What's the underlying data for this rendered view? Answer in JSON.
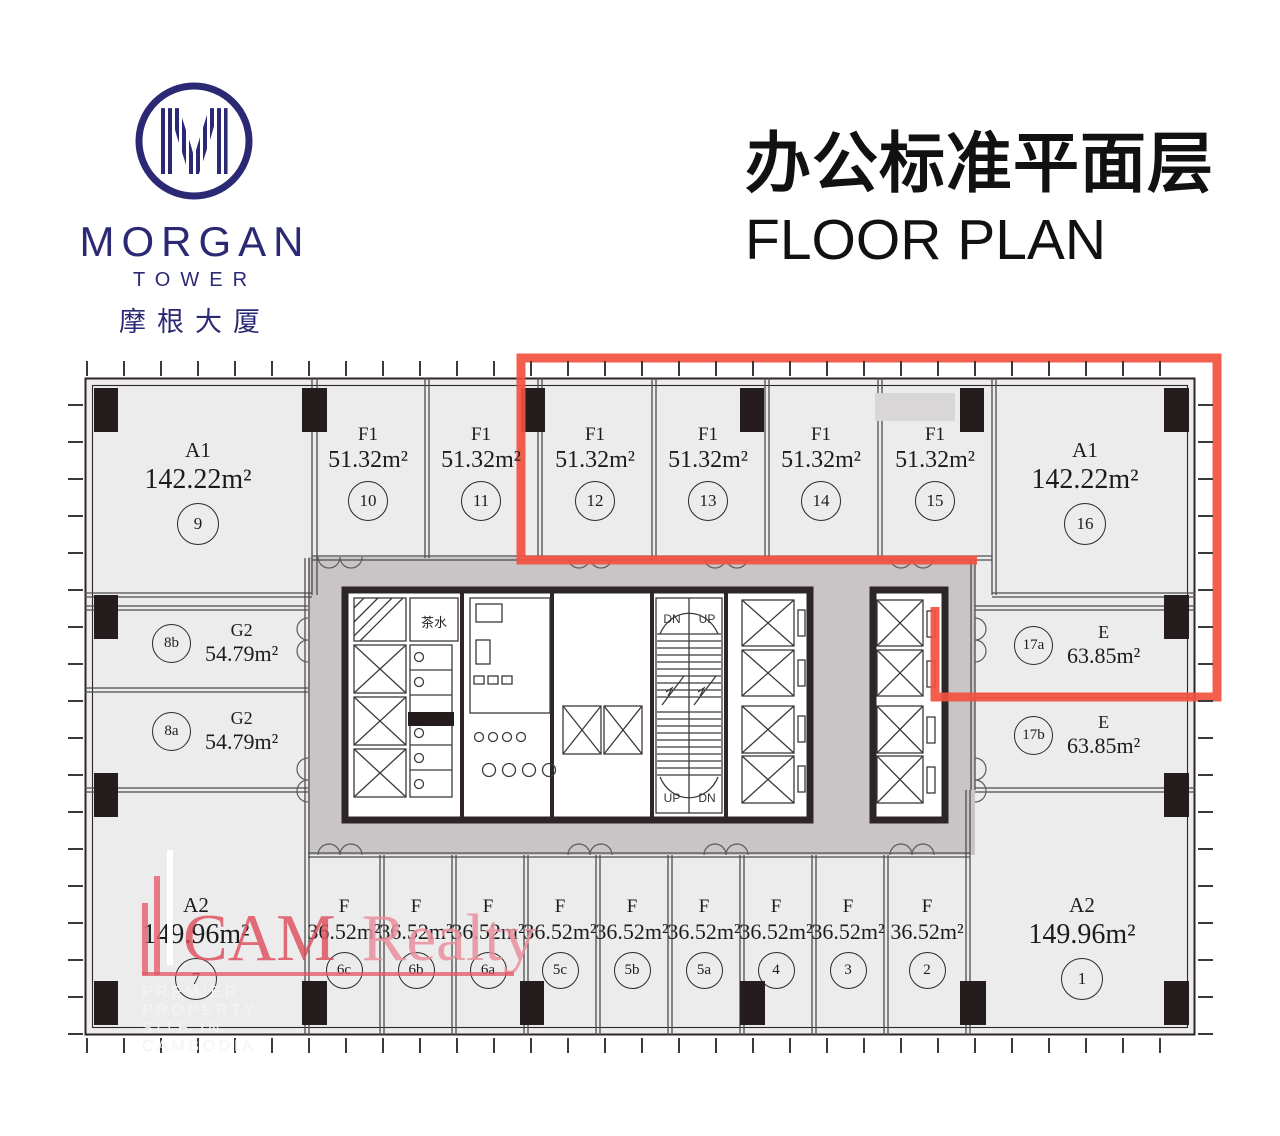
{
  "brand": {
    "monogram": "M",
    "name": "MORGAN",
    "subtitle": "TOWER",
    "chinese": "摩根大厦",
    "color": "#2b2973"
  },
  "title": {
    "zh": "办公标准平面层",
    "en": "FLOOR PLAN"
  },
  "plan": {
    "top_units": [
      {
        "type": "A1",
        "area": "142.22m²",
        "no": "9"
      },
      {
        "type": "F1",
        "area": "51.32m²",
        "no": "10"
      },
      {
        "type": "F1",
        "area": "51.32m²",
        "no": "11"
      },
      {
        "type": "F1",
        "area": "51.32m²",
        "no": "12"
      },
      {
        "type": "F1",
        "area": "51.32m²",
        "no": "13"
      },
      {
        "type": "F1",
        "area": "51.32m²",
        "no": "14"
      },
      {
        "type": "F1",
        "area": "51.32m²",
        "no": "15"
      },
      {
        "type": "A1",
        "area": "142.22m²",
        "no": "16"
      }
    ],
    "left_units": [
      {
        "type": "G2",
        "area": "54.79m²",
        "no": "8b"
      },
      {
        "type": "G2",
        "area": "54.79m²",
        "no": "8a"
      }
    ],
    "right_units": [
      {
        "type": "E",
        "area": "63.85m²",
        "no": "17a"
      },
      {
        "type": "E",
        "area": "63.85m²",
        "no": "17b"
      }
    ],
    "bottom_units": [
      {
        "type": "A2",
        "area": "149.96m²",
        "no": "7"
      },
      {
        "type": "F",
        "area": "36.52m²",
        "no": "6c"
      },
      {
        "type": "F",
        "area": "36.52m²",
        "no": "6b"
      },
      {
        "type": "F",
        "area": "36.52m²",
        "no": "6a"
      },
      {
        "type": "F",
        "area": "36.52m²",
        "no": "5c"
      },
      {
        "type": "F",
        "area": "36.52m²",
        "no": "5b"
      },
      {
        "type": "F",
        "area": "36.52m²",
        "no": "5a"
      },
      {
        "type": "F",
        "area": "36.52m²",
        "no": "4"
      },
      {
        "type": "F",
        "area": "36.52m²",
        "no": "3"
      },
      {
        "type": "F",
        "area": "36.52m²",
        "no": "2"
      },
      {
        "type": "A2",
        "area": "149.96m²",
        "no": "1"
      }
    ],
    "core": {
      "tea_room": "茶水",
      "up": "UP",
      "dn": "DN"
    },
    "highlight_color": "#f3503d"
  },
  "watermark": {
    "cam": "CAM",
    "realty": "Realty",
    "tagline": "PREMIER PROPERTY SITE IN CAMBODIA"
  }
}
